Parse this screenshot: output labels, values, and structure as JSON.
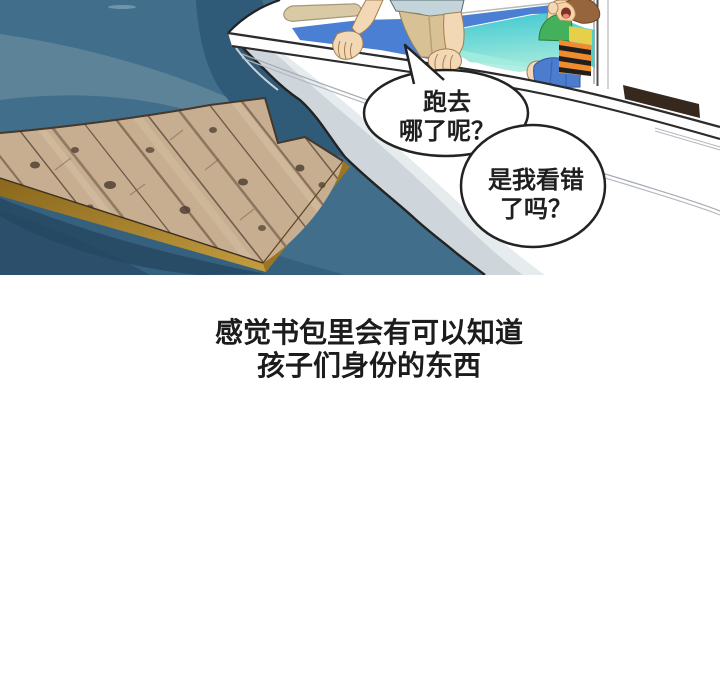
{
  "panel": {
    "bubble1": {
      "line1": "跑去",
      "line2": "哪了呢？"
    },
    "bubble2": {
      "line1": "是我看错",
      "line2": "了吗？"
    }
  },
  "caption": {
    "line1": "感觉书包里会有可以知道",
    "line2": "孩子们身份的东西"
  },
  "colors": {
    "sea_main": "#406e8b",
    "sea_light_swirl": "#5d8398",
    "sea_dark_patch": "#2f5a78",
    "sea_bottom_dark": "#2c4f6c",
    "raft_wood": "#c7ae90",
    "raft_wood_grain": "#6e5947",
    "raft_gold_edge": "#a98430",
    "hull_white": "#ffffff",
    "hull_shading": "#ced6dc",
    "pool_deep_blue": "#4a7fd3",
    "pool_turquoise": "#45cdd2",
    "pool_mint": "#a3ecde",
    "cushion_tan": "#d9c9a4",
    "shirt_blue_gray": "#c3d5da",
    "shorts_khaki": "#d7c195",
    "skin": "#f3d8b6",
    "child_hair": "#96653e",
    "vest_orange": "#f08c2e",
    "vest_yellow": "#e8cf4a",
    "shirt_green": "#43b05c",
    "child_shorts_blue": "#4c7cce",
    "cabin_window_dark": "#37281e",
    "outline": "#232323",
    "text": "#1f1f1f"
  }
}
